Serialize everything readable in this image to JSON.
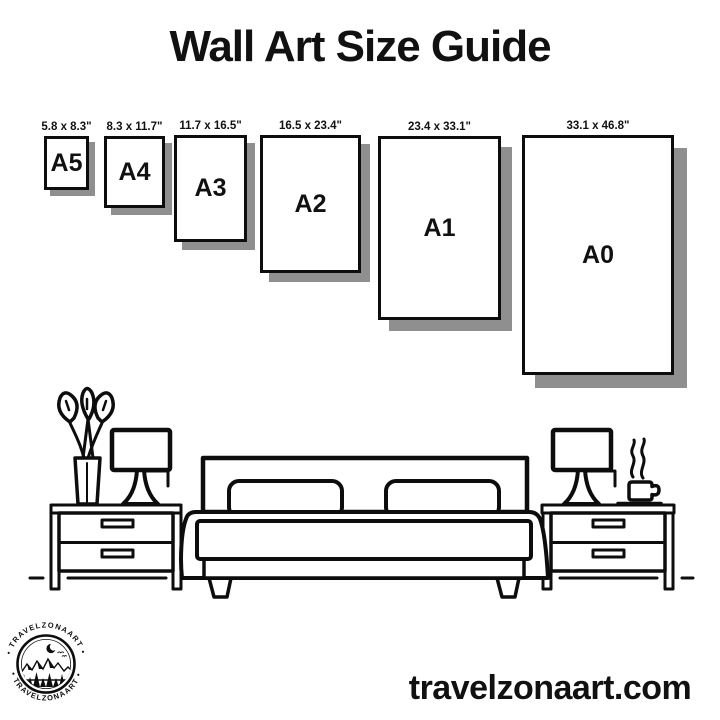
{
  "title": "Wall Art Size Guide",
  "colors": {
    "ink": "#0d0d0d",
    "shadow": "#8f8f8f",
    "background": "#ffffff"
  },
  "sizes": [
    {
      "id": "a5",
      "label": "A5",
      "dimensions": "5.8 x 8.3\"",
      "x": 44,
      "y": 136,
      "w": 45,
      "h": 54,
      "shadow_offset": 6
    },
    {
      "id": "a4",
      "label": "A4",
      "dimensions": "8.3 x 11.7\"",
      "x": 104,
      "y": 136,
      "w": 61,
      "h": 72,
      "shadow_offset": 7
    },
    {
      "id": "a3",
      "label": "A3",
      "dimensions": "11.7 x 16.5\"",
      "x": 174,
      "y": 135,
      "w": 73,
      "h": 107,
      "shadow_offset": 8
    },
    {
      "id": "a2",
      "label": "A2",
      "dimensions": "16.5 x 23.4\"",
      "x": 260,
      "y": 135,
      "w": 101,
      "h": 138,
      "shadow_offset": 9
    },
    {
      "id": "a1",
      "label": "A1",
      "dimensions": "23.4 x 33.1\"",
      "x": 378,
      "y": 136,
      "w": 123,
      "h": 184,
      "shadow_offset": 11
    },
    {
      "id": "a0",
      "label": "A0",
      "dimensions": "33.1 x 46.8\"",
      "x": 522,
      "y": 135,
      "w": 152,
      "h": 240,
      "shadow_offset": 13
    }
  ],
  "logo": {
    "badge_text_top": "• TRAVELZONAART •",
    "badge_text_bottom": "• TRAVELZONAART •"
  },
  "footer": {
    "website": "travelzonaart.com"
  }
}
